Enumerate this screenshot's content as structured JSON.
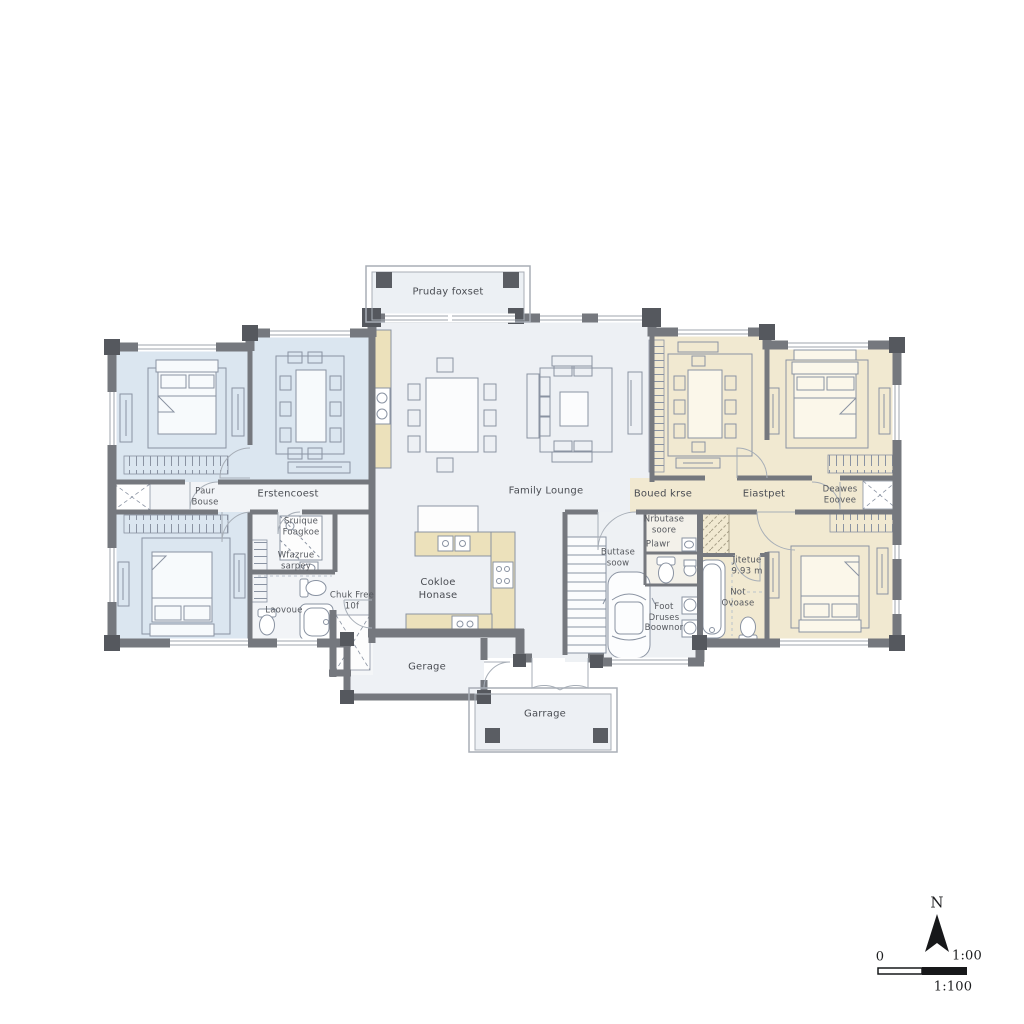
{
  "plan": {
    "rooms": {
      "porch_top": {
        "label": "Pruday foxset"
      },
      "closet_hall_left": {
        "label": "Paur\nBouse"
      },
      "hall_left": {
        "label": "Erstencoest"
      },
      "great_room": {
        "label": "Family Lounge"
      },
      "hall_mid": {
        "label": "Boued krse"
      },
      "hall_right": {
        "label": "Eiastpet"
      },
      "closet_right": {
        "label": "Deawes\nEoovee"
      },
      "shower_room": {
        "label": "Sruique\nFoagkoe"
      },
      "shower_note": {
        "label": "Wfazrue\nsarpey"
      },
      "bath_left": {
        "label": "Laovoue"
      },
      "entry_left": {
        "label": "Chuk Free\n10f"
      },
      "kitchen": {
        "label": "Cokloe\nHonase"
      },
      "garage_room": {
        "label": "Gerage"
      },
      "porch_bottom": {
        "label": "Garrage"
      },
      "mudroom": {
        "label": "Nrbutase\nsoore"
      },
      "powder_room": {
        "label": "Plawr"
      },
      "stair_hall": {
        "label": "Buttase\nsoow"
      },
      "bath_right_dim": {
        "label": "Jitetue\n9.93 m"
      },
      "bath_right": {
        "label": "Not\nOvoase"
      },
      "utility": {
        "label": "Foot\nDruses\nBoownor"
      }
    },
    "compass": {
      "north_label": "N"
    },
    "scale_bar": {
      "zero_label": "0",
      "ratio_label_top": "1:00",
      "ratio_label_bottom": "1:100"
    },
    "colors": {
      "wall": "#75787e",
      "wall_corner": "#55585e",
      "room_blue": "#dbe6f0",
      "room_beige": "#f1e9d1",
      "room_gray": "#edf0f4",
      "counter_beige": "#ece1bb",
      "furniture_line": "#8a93a2",
      "label_text": "#4a4d53"
    }
  }
}
